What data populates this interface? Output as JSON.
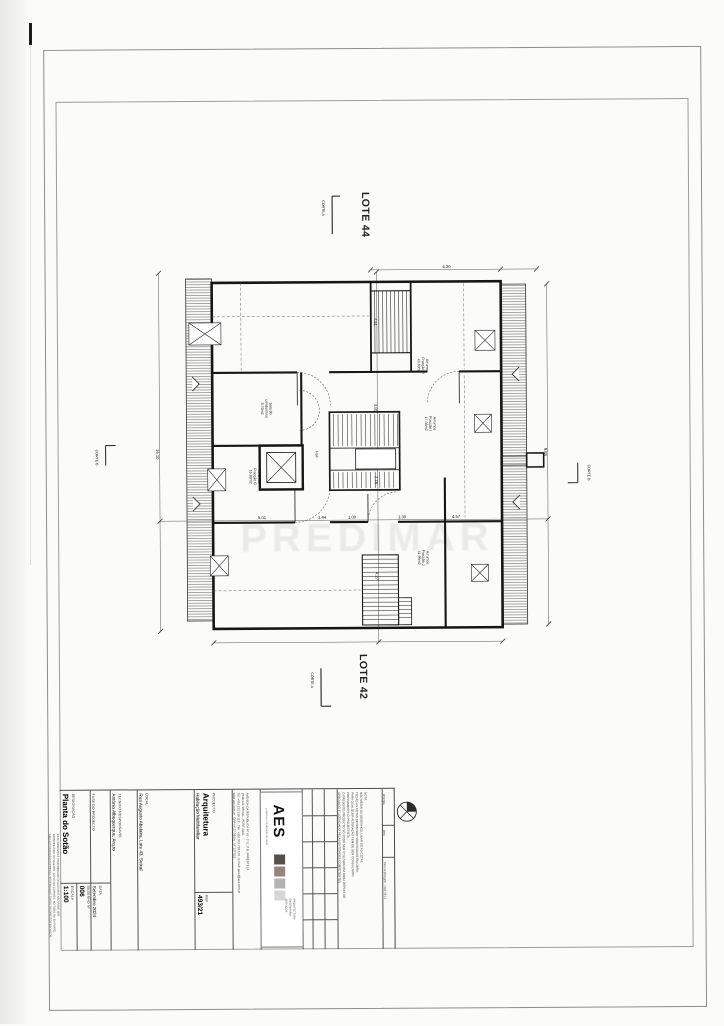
{
  "sheet": {
    "lote_top": "LOTE 44",
    "lote_bottom": "LOTE 42",
    "corte_a": "CORTE A",
    "corte_b": "CORTE B",
    "watermark": "PREDIMAR"
  },
  "plan": {
    "rooms": [
      {
        "l1": "Arrumos",
        "l2": "Fracção H",
        "l3": "43.60m2"
      },
      {
        "l1": "Arrumos",
        "l2": "Fracção I",
        "l3": "17.35m2"
      },
      {
        "l1": "Arrumos",
        "l2": "Fracção J",
        "l3": "41.95m2"
      },
      {
        "l1": "Arrumos",
        "l2": "Fracção G",
        "l3": "16.80m2"
      },
      {
        "l1": "Sala do",
        "l2": "condomínio",
        "l3": "8.70m2"
      },
      {
        "l1": "Hall",
        "l2": "",
        "l3": ""
      }
    ],
    "dims": [
      "16.10",
      "9.85",
      "4.51",
      "3.85",
      "2.78",
      "4.27",
      "4.30",
      "1.44",
      "1.00",
      "1.30",
      "5.01",
      "4.57"
    ]
  },
  "title_block": {
    "fields": {
      "projecto_label": "PROJECTO",
      "projecto_value1": "Arquitetura",
      "projecto_value2": "Habitação Multifamiliar",
      "local_label": "LOCAL",
      "local_value": "Rua Augusto Abelaira, Lote 43, Seixal",
      "tecnico_label": "TECNICO RESPONSAVEL",
      "tecnico_value": "António Albuquerque, Arq.to",
      "fase_label": "FASE DO PROJECTO",
      "data_label": "DATA",
      "data_value": "Setembro 2024",
      "designacao_label": "DESIGNAÇÃO",
      "designacao_value": "Planta do Sotão",
      "escala_label": "ESCALA",
      "escala_value": "1:100",
      "desenho_label": "DESENHO Nº",
      "desenho_value": "006",
      "ref_label": "REF",
      "ref_value": "493/21"
    },
    "address_lines": [
      "AVENIDA DA REPUBLICA Nº 61 - 1º E 1º B, ARRENTELA",
      "2840-141 SEIXAL - PORTUGAL",
      "Tel: +351 212 219 119 · Tlm: +351 912 219 120 · E-mail: geral@aes.com.pt",
      "www.aes.com.pt · CRP Nº 27 DESA · Nº 1377/21"
    ],
    "logo": {
      "name": "AES",
      "tagline": "projectos e fiscalização de obras",
      "caption1": "ARQUITECTURA",
      "caption2": "ENGENHARIA",
      "caption3": "SERVIÇOS",
      "colors": [
        "#55504b",
        "#9a8280",
        "#b3b3b3",
        "#d6d6d6"
      ]
    },
    "nota_lines": [
      "NOTA:",
      "NÃO MEDIR OS DESENHOS, USAR SÓ AS COTAS",
      "TODAS AS COTAS DEVEM SER VERIFICADAS EM OBRA,",
      "PARA QUALQUER ALTERAÇÃO TEM DE SER CONSULTADO",
      "PREVIAMENTE O PROJECTISTA.",
      "O PRESENTE PROJECTO SÓ PODE SER UTILIZADO EM OBRA DEPOIS DE",
      "APROVADO E LICENCIADO PELAS ENTIDADES COMPETENTES."
    ],
    "emenda_label": "emenda",
    "data_col_label": "data",
    "plot_date": "Data de plotagem : 2024-09-11",
    "disclaimer_lines": [
      "ESTE DESENHO É PROPRIEDADE DO AUTOR E NÃO PODE SER",
      "REPRODUZIDO, DIVULGADO, SALVO OU COPIADO, NO TODO OU EM PARTE,",
      "SEM AUTORIZAÇÃO EXPRESSA. RESERVADOS TODOS OS DIREITOS EM VIGOR."
    ]
  }
}
